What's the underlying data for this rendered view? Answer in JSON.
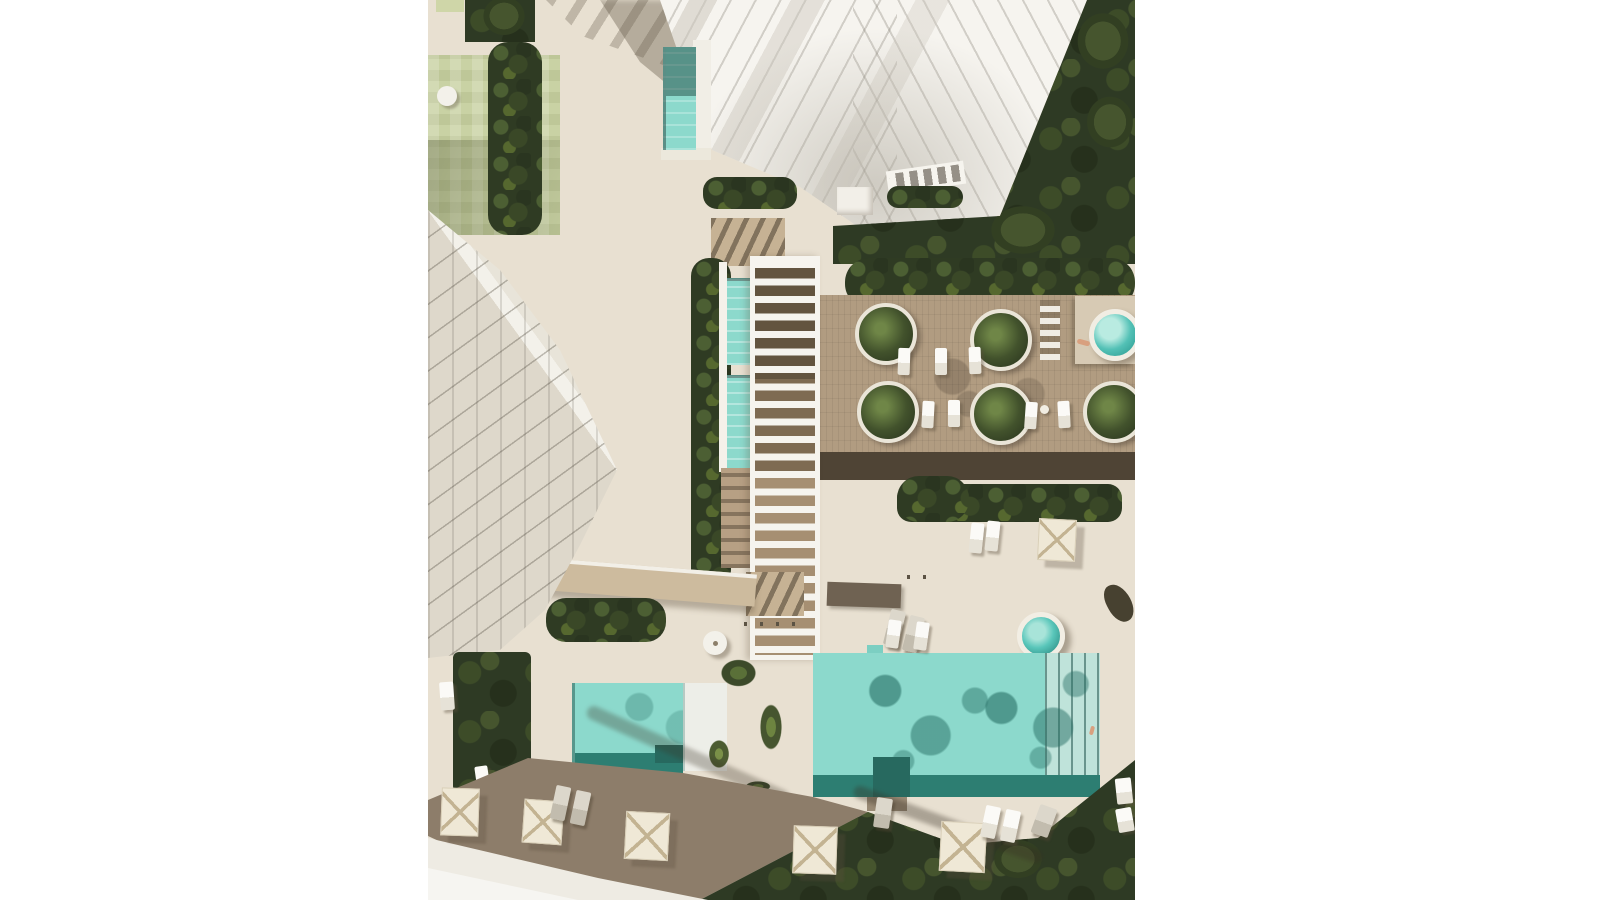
{
  "scene": {
    "type": "architectural-aerial-render",
    "description": "Top-down 3D rendering of a beachfront residential resort: a white high-rise tower at top, a white low-rise apartment block at lower left, a central white pergola walkway with two turquoise lap channels, a wooden amenity deck with round planters, sun loungers and a raised spa, a plaza with a small round plunge pool, a large rectangular swimming pool and a kids pool with palm trees, cream umbrellas and loungers, surrounded by dark green landscaping on a white page background.",
    "objects": {
      "towers": 2,
      "round_planters": 5,
      "spa_pools": 2,
      "rect_pools": 3,
      "lap_channels": 2,
      "umbrellas": 6,
      "sun_loungers": 20,
      "palm_clusters": 2,
      "people": 2
    }
  },
  "palette": {
    "page-bg": "#ffffff",
    "plaza": "#e8e0d1",
    "plaza-light": "#ece5d7",
    "wood-deck": "#b19c81",
    "wood-dark": "#4f4435",
    "wood-steps": "#c6b294",
    "apron-dark": "#8d7d6a",
    "pool": "#8cd9cc",
    "pool-light": "#bfe3da",
    "pool-band": "#2d7e72",
    "pool-deep": "#27695f",
    "spa-water": "#59c6ba",
    "green-dark": "#2f3b23",
    "green-mid": "#45552f",
    "lawn-light": "#c9d2a4",
    "building-white": "#f6f4ef",
    "building-line": "#d9d4c8",
    "roof-dark": "#595144",
    "shadow": "rgba(97,87,70,0.38)",
    "cream": "#efe8d6",
    "umbrella-line": "#c3b392",
    "skin": "#d8a07f",
    "path-light": "#eeebe3"
  }
}
